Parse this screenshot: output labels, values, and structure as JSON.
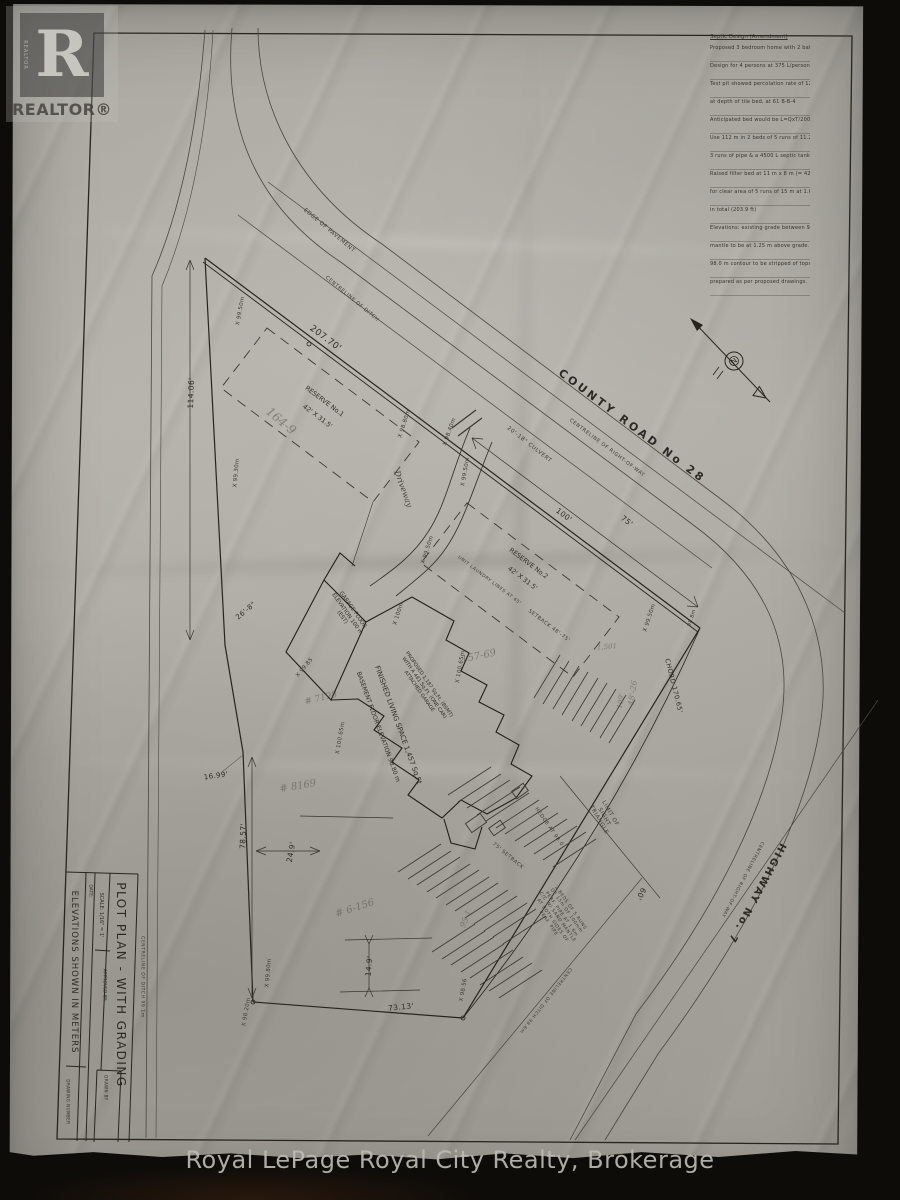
{
  "watermark": {
    "logo_letter": "R",
    "logo_word_vertical": "REALTOR",
    "label": "REALTOR®"
  },
  "footer": {
    "text": "Royal LePage Royal City Realty, Brokerage"
  },
  "compass": {
    "north_letter": "N"
  },
  "title_block": {
    "title": "PLOT PLAN - WITH GRADING",
    "scale": "SCALE: 1/16\" = 1'",
    "date_label": "DATE:",
    "approved_label": "APPROVED BY:",
    "drawn_label": "DRAWN BY",
    "drawing_number_label": "DRAWING NUMBER",
    "note": "ELEVATIONS SHOWN IN METERS"
  },
  "notes": {
    "title": "Septic Design (Amendment)",
    "lines": [
      "Proposed 3 bedroom home with 2 bathrooms",
      "Design for 4 persons at 375 L/person/day = 1500 L/day",
      "Test pit showed percolation rate of 12.5 min/cm",
      "at depth of tile bed, at 61 B-B-4",
      "Anticipated bed would be L=QxT/200 = 1500x12.5/200 = 112.5 m",
      "Use 112 m in 2 beds of 5 runs of 11.2 m (750 mm in 2 beds) with",
      "3 runs of pipe & a 4500 L septic tank (1000 gal)",
      "Raised filter bed at 11 m x 8 m (= 42' x 31.5') to provide",
      "for clear area of 5 runs of 15 m at 1.6 m c/c for 153 m",
      "in total (203.9 ft)",
      "Elevations: existing grade between 98.0 & 99.25 m. Bed",
      "mantle to be at 1.25 m above grade. Area down to the",
      "98.0 m contour to be stripped of topsoil &",
      "prepared as per proposed drawings."
    ]
  },
  "labels": [
    {
      "name": "county-road-name",
      "text": "COUNTY ROAD No 28",
      "x": 632,
      "y": 426,
      "rot": 37,
      "size": 11,
      "cls": "road",
      "ls": 3,
      "w": "bold"
    },
    {
      "name": "county-centreline",
      "text": "CENTRELINE OF RIGHT-OF-WAY",
      "x": 607,
      "y": 448,
      "rot": 37,
      "size": 5,
      "cls": "tiny"
    },
    {
      "name": "edge-of-pavement",
      "text": "EDGE OF PAVEMENT",
      "x": 329,
      "y": 231,
      "rot": 40,
      "size": 5.5,
      "cls": "tiny"
    },
    {
      "name": "ditch-centreline-top",
      "text": "CENTRELINE OF DITCH",
      "x": 352,
      "y": 299,
      "rot": 40,
      "size": 5,
      "cls": "tiny"
    },
    {
      "name": "highway-name",
      "text": "HIGHWAY No. 7",
      "x": 756,
      "y": 893,
      "rot": 118,
      "size": 10,
      "cls": "road",
      "ls": 2,
      "w": "bold"
    },
    {
      "name": "highway-centreline",
      "text": "CENTRELINE OF RIGHT-OF-WAY",
      "x": 742,
      "y": 879,
      "rot": 118,
      "size": 4.5,
      "cls": "tiny"
    },
    {
      "name": "ditch-centreline-br",
      "text": "CENTRELINE OF DITCH 98.6m",
      "x": 545,
      "y": 1000,
      "rot": 128,
      "size": 4.5,
      "cls": "tiny"
    },
    {
      "name": "ditch-centreline-left",
      "text": "CENTRELINE OF DITCH 99.1m",
      "x": 142,
      "y": 977,
      "rot": 90,
      "size": 4.5,
      "cls": "tiny"
    },
    {
      "name": "dim-207-70",
      "text": "207.70'",
      "x": 325,
      "y": 339,
      "rot": 37,
      "size": 9,
      "cls": "dim"
    },
    {
      "name": "dim-114-06",
      "text": "114.06'",
      "x": 191,
      "y": 393,
      "rot": -88,
      "size": 7.5,
      "cls": "dim"
    },
    {
      "name": "dim-100",
      "text": "100'",
      "x": 564,
      "y": 515,
      "rot": 37,
      "size": 7.5,
      "cls": "dim"
    },
    {
      "name": "dim-75",
      "text": "75'",
      "x": 627,
      "y": 521,
      "rot": 37,
      "size": 7.5,
      "cls": "dim"
    },
    {
      "name": "dim-chord",
      "text": "CHORD 170.65'",
      "x": 673,
      "y": 686,
      "rot": 76,
      "size": 6.5,
      "cls": "dim"
    },
    {
      "name": "dim-60",
      "text": "60'",
      "x": 641,
      "y": 894,
      "rot": 118,
      "size": 7.5,
      "cls": "dim"
    },
    {
      "name": "dim-78-57",
      "text": "78.57'",
      "x": 243,
      "y": 836,
      "rot": -88,
      "size": 7.5,
      "cls": "dim"
    },
    {
      "name": "dim-24-9",
      "text": "24.9'",
      "x": 291,
      "y": 852,
      "rot": -80,
      "size": 7.5,
      "cls": "dim"
    },
    {
      "name": "dim-14-9",
      "text": "14.9'",
      "x": 369,
      "y": 966,
      "rot": -85,
      "size": 7.5,
      "cls": "dim"
    },
    {
      "name": "dim-73-13",
      "text": "73.13'",
      "x": 401,
      "y": 1007,
      "rot": -6,
      "size": 7.5,
      "cls": "dim"
    },
    {
      "name": "dim-26-8",
      "text": "26'-8\"",
      "x": 246,
      "y": 611,
      "rot": -40,
      "size": 7,
      "cls": "dim"
    },
    {
      "name": "dim-16-99",
      "text": "16.99'",
      "x": 216,
      "y": 776,
      "rot": -8,
      "size": 7,
      "cls": "dim"
    },
    {
      "name": "reserve1-name",
      "text": "RESERVE No.1",
      "x": 324,
      "y": 402,
      "rot": 37,
      "size": 6.5,
      "cls": "ink"
    },
    {
      "name": "reserve1-size",
      "text": "42' X 31.5'",
      "x": 317,
      "y": 417,
      "rot": 37,
      "size": 6.5,
      "cls": "ink"
    },
    {
      "name": "reserve2-name",
      "text": "RESERVE No.2",
      "x": 528,
      "y": 564,
      "rot": 37,
      "size": 6.5,
      "cls": "ink"
    },
    {
      "name": "reserve2-size",
      "text": "42' X 31.5'",
      "x": 522,
      "y": 579,
      "rot": 37,
      "size": 6.5,
      "cls": "ink"
    },
    {
      "name": "reserve2-note",
      "text": "UNIT LAUNDRY LINES AT 45'",
      "x": 489,
      "y": 581,
      "rot": 37,
      "size": 4.5,
      "cls": "tiny"
    },
    {
      "name": "setback-note",
      "text": "SETBACK 48'-75'",
      "x": 549,
      "y": 626,
      "rot": 37,
      "size": 5,
      "cls": "tiny"
    },
    {
      "name": "setback-75",
      "text": "75' SETBACK",
      "x": 508,
      "y": 856,
      "rot": 40,
      "size": 5,
      "cls": "tiny"
    },
    {
      "name": "sight-triangle-note",
      "lines": [
        "LIMIT OF",
        "SIGHT",
        "TRIANGLE"
      ],
      "x": 604,
      "y": 817,
      "rot": 60,
      "size": 5.5,
      "cls": "tiny"
    },
    {
      "name": "hedge-note",
      "text": "HEDGE AT 98.0",
      "x": 549,
      "y": 827,
      "rot": 55,
      "size": 5,
      "cls": "tiny"
    },
    {
      "name": "culvert-note",
      "text": "20'-18\" CULVERT",
      "x": 529,
      "y": 445,
      "rot": 38,
      "size": 5.5,
      "cls": "tiny"
    },
    {
      "name": "septic-bed-note",
      "lines": [
        "2 BEDS OF 5 RUNS",
        "OF 15m OF 100mm",
        "PERF. PIPE AT 1.6m",
        "C/C W/ SAND MANTLE",
        "AT BOTH SIDES OF",
        "PERF. PIPE"
      ],
      "x": 559,
      "y": 916,
      "rot": 55,
      "size": 4.5,
      "cls": "tiny"
    },
    {
      "name": "garage-floor-note",
      "lines": [
        "GARAGE FLOOR",
        "ELEVATION 100 m",
        "(EST)"
      ],
      "x": 347,
      "y": 614,
      "rot": 55,
      "size": 5.5,
      "cls": "ink"
    },
    {
      "name": "proposed-house-note",
      "lines": [
        "PROPOSED 1,187 Sq.Ft. (BSMT)",
        "WITH A 481 Sq.Ft. (ONE CAR)",
        "ATTACHED GARAGE"
      ],
      "x": 424,
      "y": 688,
      "rot": 55,
      "size": 5,
      "cls": "ink"
    },
    {
      "name": "living-space-note",
      "text": "FINISHED LIVING SPACE 1,457 Sq.Ft",
      "x": 398,
      "y": 725,
      "rot": 70,
      "size": 7,
      "cls": "ink"
    },
    {
      "name": "basement-note",
      "text": "BASEMENT FLOOR ELEVATION 98.80 m",
      "x": 378,
      "y": 727,
      "rot": 70,
      "size": 6,
      "cls": "ink"
    },
    {
      "name": "driveway-label",
      "text": "Driveway",
      "x": 403,
      "y": 489,
      "rot": 70,
      "size": 8,
      "cls": "script"
    },
    {
      "name": "spot-elevation-1",
      "text": "X 99.50m",
      "x": 241,
      "y": 311,
      "rot": -80,
      "size": 5.5,
      "cls": "elev"
    },
    {
      "name": "spot-elevation-2",
      "text": "X 99.30m",
      "x": 237,
      "y": 473,
      "rot": -85,
      "size": 5.5,
      "cls": "elev"
    },
    {
      "name": "spot-elevation-3",
      "text": "X 98.80m",
      "x": 405,
      "y": 424,
      "rot": -72,
      "size": 5.5,
      "cls": "elev"
    },
    {
      "name": "spot-elevation-4",
      "text": "X 98.40m",
      "x": 450,
      "y": 432,
      "rot": -70,
      "size": 5.5,
      "cls": "elev"
    },
    {
      "name": "spot-elevation-5",
      "text": "X 99.50m",
      "x": 466,
      "y": 472,
      "rot": -80,
      "size": 5.5,
      "cls": "elev"
    },
    {
      "name": "spot-elevation-6",
      "text": "X 99.50m",
      "x": 650,
      "y": 618,
      "rot": -72,
      "size": 5.5,
      "cls": "elev"
    },
    {
      "name": "spot-elevation-7",
      "text": "X 99.50m",
      "x": 428,
      "y": 550,
      "rot": -72,
      "size": 5.5,
      "cls": "elev"
    },
    {
      "name": "spot-elevation-8",
      "text": "X 100m",
      "x": 399,
      "y": 614,
      "rot": -72,
      "size": 5.5,
      "cls": "elev"
    },
    {
      "name": "spot-elevation-9",
      "text": "X 100.65m",
      "x": 341,
      "y": 738,
      "rot": -80,
      "size": 5.5,
      "cls": "elev"
    },
    {
      "name": "spot-elevation-10",
      "text": "X 100.65m",
      "x": 461,
      "y": 667,
      "rot": -80,
      "size": 5.5,
      "cls": "elev"
    },
    {
      "name": "spot-elevation-11",
      "text": "X 99.85",
      "x": 305,
      "y": 668,
      "rot": -50,
      "size": 5.5,
      "cls": "elev"
    },
    {
      "name": "spot-elevation-12",
      "text": "X 99.80m",
      "x": 269,
      "y": 973,
      "rot": -85,
      "size": 5.5,
      "cls": "elev"
    },
    {
      "name": "spot-elevation-13",
      "text": "X 98.56",
      "x": 464,
      "y": 990,
      "rot": -80,
      "size": 5.5,
      "cls": "elev"
    },
    {
      "name": "spot-elevation-14",
      "text": "98.8m",
      "x": 692,
      "y": 618,
      "rot": -72,
      "size": 5,
      "cls": "elev"
    },
    {
      "name": "spot-elevation-15",
      "text": "X 98.20m",
      "x": 247,
      "y": 1012,
      "rot": -80,
      "size": 5.5,
      "cls": "elev"
    },
    {
      "name": "pencil-note-1",
      "text": "164-9",
      "x": 281,
      "y": 421,
      "rot": 40,
      "size": 12,
      "cls": "pencil"
    },
    {
      "name": "pencil-note-2",
      "text": "157-69",
      "x": 479,
      "y": 657,
      "rot": -12,
      "size": 10,
      "cls": "pencil"
    },
    {
      "name": "pencil-note-3",
      "text": "48'-26",
      "x": 633,
      "y": 693,
      "rot": -82,
      "size": 8,
      "cls": "pencil"
    },
    {
      "name": "pencil-note-4",
      "text": "# 7198",
      "x": 321,
      "y": 699,
      "rot": -14,
      "size": 9,
      "cls": "pencil"
    },
    {
      "name": "pencil-note-5",
      "text": "# 8169",
      "x": 298,
      "y": 787,
      "rot": -10,
      "size": 10,
      "cls": "pencil"
    },
    {
      "name": "pencil-note-6",
      "text": "# 6-156",
      "x": 355,
      "y": 909,
      "rot": -18,
      "size": 10,
      "cls": "pencil"
    },
    {
      "name": "pencil-note-7",
      "text": "95-1",
      "x": 466,
      "y": 919,
      "rot": -68,
      "size": 8,
      "cls": "pencil"
    },
    {
      "name": "pencil-note-8",
      "text": "1,501",
      "x": 607,
      "y": 647,
      "rot": -5,
      "size": 7,
      "cls": "pencil"
    },
    {
      "name": "pencil-note-9",
      "text": "109'",
      "x": 621,
      "y": 701,
      "rot": -80,
      "size": 7,
      "cls": "pencil"
    }
  ]
}
